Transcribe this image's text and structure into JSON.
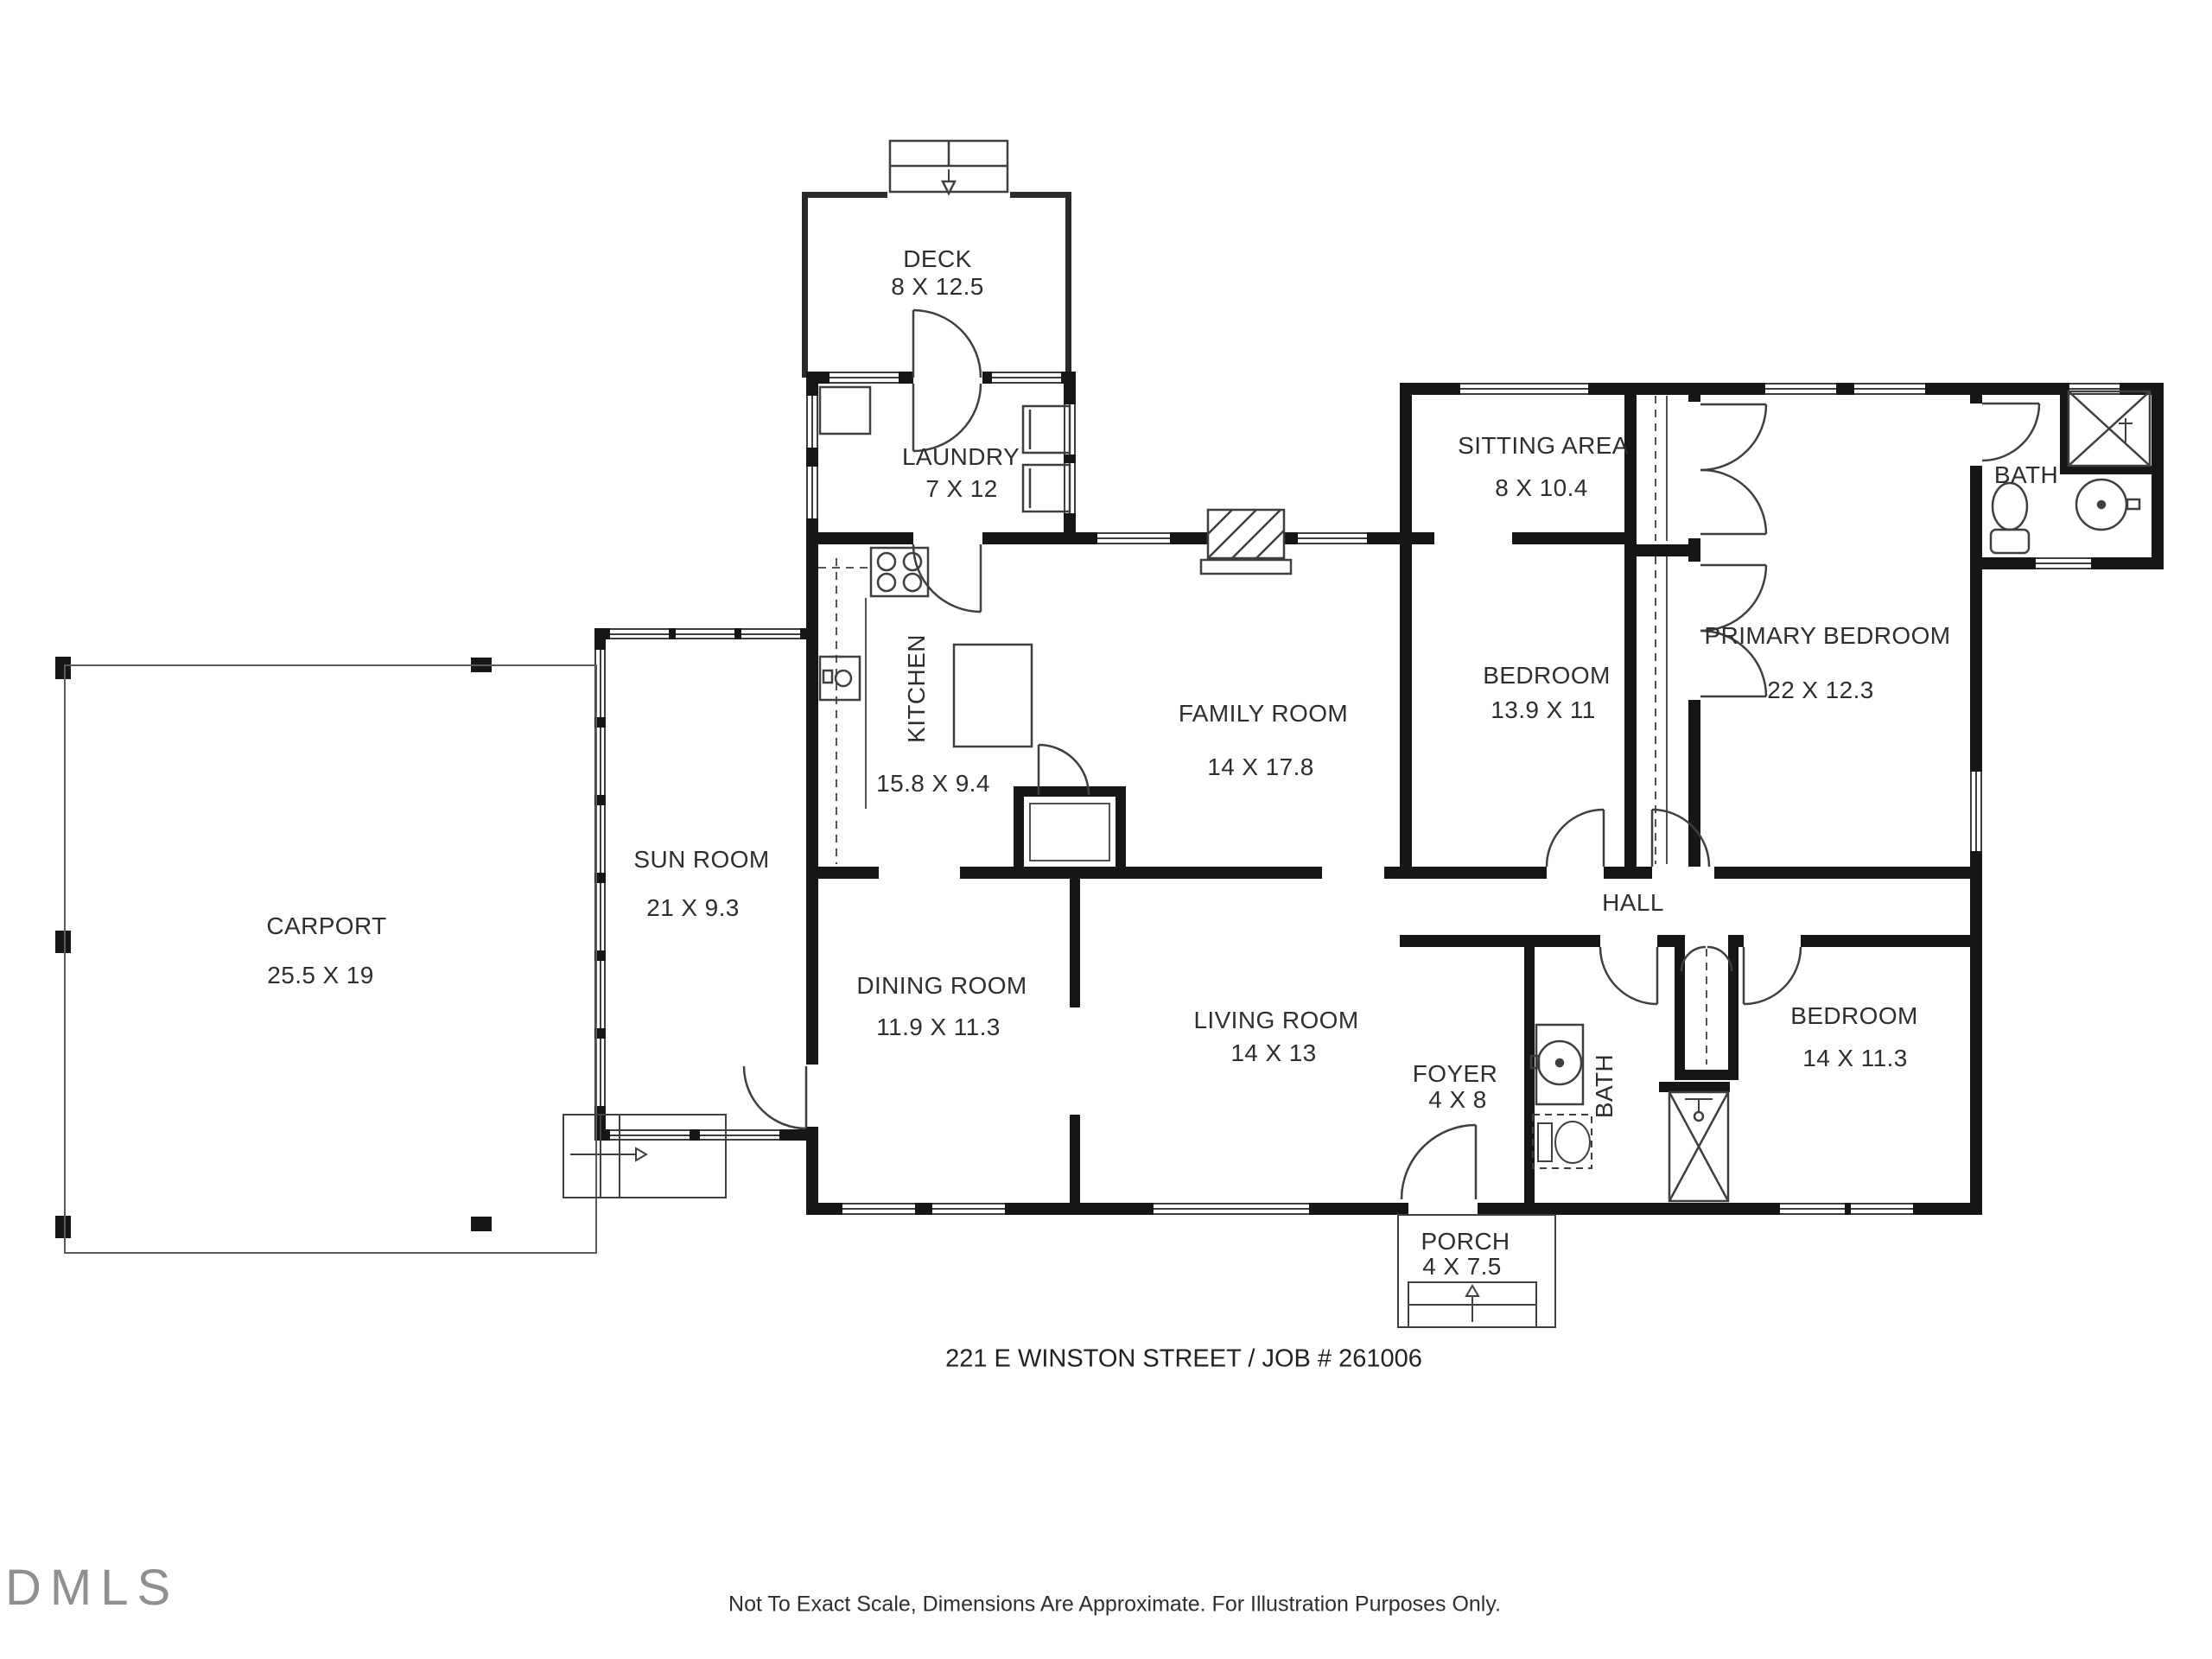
{
  "plan": {
    "address_line": "221 E WINSTON STREET / JOB # 261006",
    "disclaimer": "Not To Exact Scale, Dimensions Are Approximate. For Illustration Purposes Only.",
    "logo_text": "DMLS",
    "rooms": {
      "deck": {
        "name": "DECK",
        "dims": "8 X 12.5"
      },
      "laundry": {
        "name": "LAUNDRY",
        "dims": "7 X 12"
      },
      "kitchen": {
        "name": "KITCHEN",
        "dims": "15.8 X 9.4"
      },
      "family_room": {
        "name": "FAMILY ROOM",
        "dims": "14 X 17.8"
      },
      "sitting_area": {
        "name": "SITTING AREA",
        "dims": "8 X 10.4"
      },
      "bedroom_mid": {
        "name": "BEDROOM",
        "dims": "13.9 X 11"
      },
      "primary_bedroom": {
        "name": "PRIMARY BEDROOM",
        "dims": "22 X 12.3"
      },
      "bath_top": {
        "name": "BATH"
      },
      "hall": {
        "name": "HALL"
      },
      "sun_room": {
        "name": "SUN ROOM",
        "dims": "21 X 9.3"
      },
      "carport": {
        "name": "CARPORT",
        "dims": "25.5 X 19"
      },
      "dining_room": {
        "name": "DINING ROOM",
        "dims": "11.9 X 11.3"
      },
      "living_room": {
        "name": "LIVING ROOM",
        "dims": "14 X 13"
      },
      "foyer": {
        "name": "FOYER",
        "dims": "4 X 8"
      },
      "bath_mid": {
        "name": "BATH"
      },
      "bedroom_right": {
        "name": "BEDROOM",
        "dims": "14 X 11.3"
      },
      "porch": {
        "name": "PORCH",
        "dims": "4 X 7.5"
      }
    }
  }
}
